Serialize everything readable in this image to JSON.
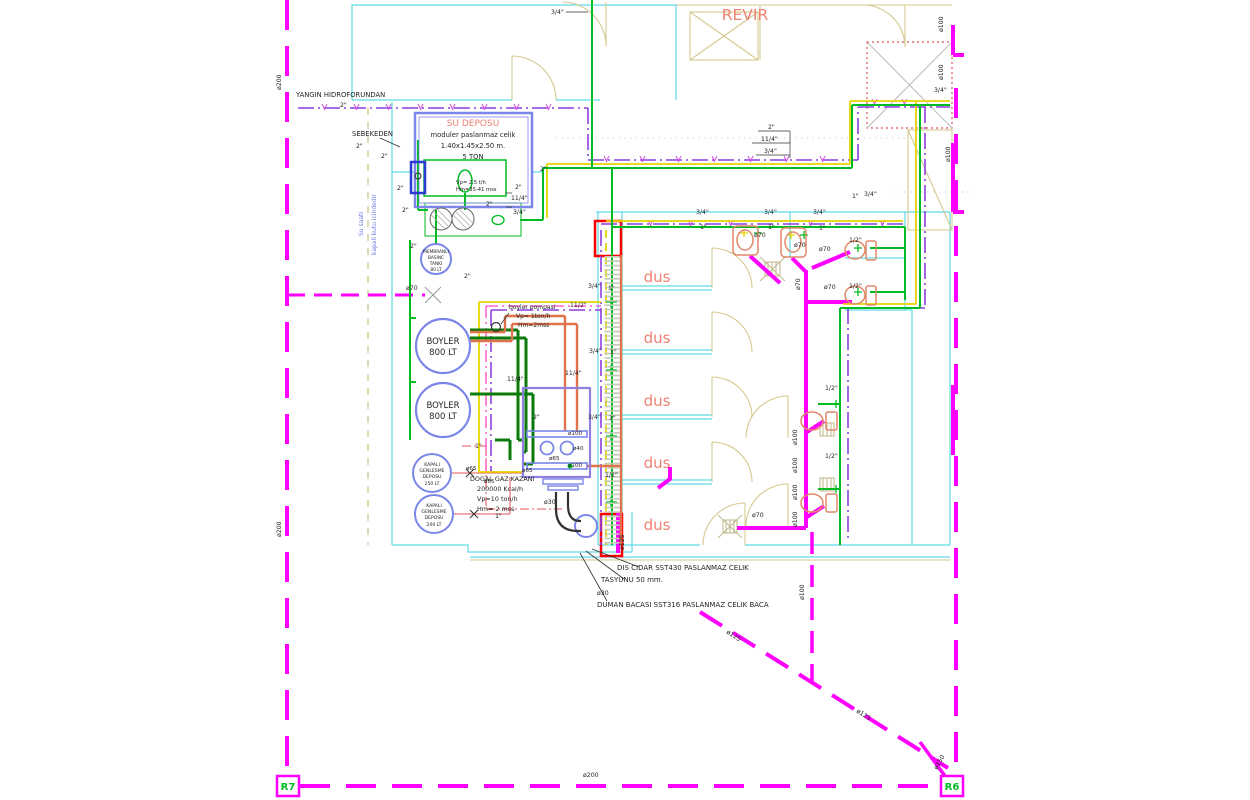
{
  "title": "Mekanik Tesisat Plani - Revir / Dus Mahalli",
  "colors": {
    "black": "#1f1f1f",
    "salmon": "#ee8172",
    "blue": "#6f7ae0",
    "green": "#00bb22",
    "magenta": "#ff00ff",
    "purple": "#8b3fe0",
    "yellow": "#e6d400",
    "orange": "#e0734b",
    "cyan_wall": "#5fd9e6",
    "tan": "#d5c98f",
    "red": "#ff0000",
    "periwinkle": "#7b86e8"
  },
  "labels": [
    {
      "id": "yangin-hidroforundan-label",
      "t": "YANGIN HIDROFORUNDAN",
      "x": 296,
      "y": 97,
      "s": 6.8
    },
    {
      "id": "size-2in-01",
      "t": "2\"",
      "x": 340,
      "y": 107
    },
    {
      "id": "sebekeden-label",
      "t": "SEBEKEDEN",
      "x": 352,
      "y": 136,
      "s": 6.8
    },
    {
      "id": "size-2in-02",
      "t": "2\"",
      "x": 356,
      "y": 148
    },
    {
      "id": "su-deposu-title",
      "t": "SU DEPOSU",
      "x": 473,
      "y": 126,
      "s": 9,
      "c": "salmon",
      "a": "m"
    },
    {
      "id": "su-deposu-spec-1",
      "t": "moduler paslanmaz celik",
      "x": 473,
      "y": 137,
      "s": 6.8,
      "a": "m"
    },
    {
      "id": "su-deposu-spec-2",
      "t": "1.40x1.45x2.50 m.",
      "x": 473,
      "y": 148,
      "s": 6.8,
      "a": "m"
    },
    {
      "id": "su-deposu-spec-3",
      "t": "5 TON",
      "x": 473,
      "y": 159,
      "s": 6.8,
      "a": "m"
    },
    {
      "id": "hidrofor-spec-1",
      "t": "Vp= 2.5 t/h",
      "x": 456,
      "y": 184,
      "s": 5.2
    },
    {
      "id": "hidrofor-spec-2",
      "t": "Hm=35-41 mss",
      "x": 456,
      "y": 191,
      "s": 5.2
    },
    {
      "id": "su-saati-note-1",
      "t": "Su saati",
      "x": 363,
      "y": 236,
      "s": 6,
      "c": "blue",
      "r": -90
    },
    {
      "id": "su-saati-note-2",
      "t": "kapali kutu icindedir",
      "x": 376,
      "y": 255,
      "s": 6,
      "c": "blue",
      "r": -90
    },
    {
      "id": "size-2in-03",
      "t": "2\"",
      "x": 381,
      "y": 158
    },
    {
      "id": "size-2in-04",
      "t": "2\"",
      "x": 397,
      "y": 190
    },
    {
      "id": "size-2in-05",
      "t": "2\"",
      "x": 402,
      "y": 212
    },
    {
      "id": "size-2in-06",
      "t": "2\"",
      "x": 410,
      "y": 248
    },
    {
      "id": "size-2in-07",
      "t": "2\"",
      "x": 486,
      "y": 206
    },
    {
      "id": "size-2in-08",
      "t": "2\"",
      "x": 515,
      "y": 189
    },
    {
      "id": "size-114-01",
      "t": "11/4\"",
      "x": 511,
      "y": 200
    },
    {
      "id": "size-34-01",
      "t": "3/4\"",
      "x": 513,
      "y": 214
    },
    {
      "id": "size-2in-09",
      "t": "2\"",
      "x": 540,
      "y": 171
    },
    {
      "id": "membran-tank-line-1",
      "t": "MEMBRANLI",
      "x": 436,
      "y": 253,
      "s": 4.3,
      "a": "m"
    },
    {
      "id": "membran-tank-line-2",
      "t": "BASINC",
      "x": 436,
      "y": 259,
      "s": 4.3,
      "a": "m"
    },
    {
      "id": "membran-tank-line-3",
      "t": "TANKI",
      "x": 436,
      "y": 265,
      "s": 4.3,
      "a": "m"
    },
    {
      "id": "membran-tank-line-4",
      "t": "80 LT",
      "x": 436,
      "y": 271,
      "s": 4.3,
      "a": "m"
    },
    {
      "id": "size-2in-10",
      "t": "2\"",
      "x": 464,
      "y": 278
    },
    {
      "id": "dia70-01",
      "t": "ø70",
      "x": 406,
      "y": 290
    },
    {
      "id": "boyler-pompasi-line-1",
      "t": "boyler pompasi",
      "x": 509,
      "y": 309,
      "s": 6
    },
    {
      "id": "boyler-pompasi-line-2",
      "t": "Vp= 1ton/h",
      "x": 516,
      "y": 318,
      "s": 6
    },
    {
      "id": "boyler-pompasi-line-3",
      "t": "Hm=2mss",
      "x": 518,
      "y": 327,
      "s": 6
    },
    {
      "id": "boyler1-label-1",
      "t": "BOYLER",
      "x": 443,
      "y": 344,
      "s": 8.5,
      "a": "m"
    },
    {
      "id": "boyler1-label-2",
      "t": "800 LT",
      "x": 443,
      "y": 355,
      "s": 8.5,
      "a": "m"
    },
    {
      "id": "boyler2-label-1",
      "t": "BOYLER",
      "x": 443,
      "y": 408,
      "s": 8.5,
      "a": "m"
    },
    {
      "id": "boyler2-label-2",
      "t": "800 LT",
      "x": 443,
      "y": 419,
      "s": 8.5,
      "a": "m"
    },
    {
      "id": "size-112-01",
      "t": "11/2\"",
      "x": 570,
      "y": 307
    },
    {
      "id": "size-114-02",
      "t": "11/4\"",
      "x": 507,
      "y": 381
    },
    {
      "id": "size-114-03",
      "t": "11/4\"",
      "x": 565,
      "y": 375
    },
    {
      "id": "size-2in-11",
      "t": "2\"",
      "x": 533,
      "y": 419
    },
    {
      "id": "genlesme1-line-1",
      "t": "KAPALI",
      "x": 432,
      "y": 466,
      "s": 4.6,
      "a": "m"
    },
    {
      "id": "genlesme1-line-2",
      "t": "GENLESME",
      "x": 432,
      "y": 472,
      "s": 4.6,
      "a": "m"
    },
    {
      "id": "genlesme1-line-3",
      "t": "DEPOSU",
      "x": 432,
      "y": 478,
      "s": 4.6,
      "a": "m"
    },
    {
      "id": "genlesme1-line-4",
      "t": "250 LT",
      "x": 432,
      "y": 485,
      "s": 4.6,
      "a": "m"
    },
    {
      "id": "genlesme2-line-1",
      "t": "KAPALI",
      "x": 434,
      "y": 507,
      "s": 4.6,
      "a": "m"
    },
    {
      "id": "genlesme2-line-2",
      "t": "GENLESME",
      "x": 434,
      "y": 513,
      "s": 4.6,
      "a": "m"
    },
    {
      "id": "genlesme2-line-3",
      "t": "DEPOSU",
      "x": 434,
      "y": 519,
      "s": 4.6,
      "a": "m"
    },
    {
      "id": "genlesme2-line-4",
      "t": "200 LT",
      "x": 434,
      "y": 526,
      "s": 4.6,
      "a": "m"
    },
    {
      "id": "size-1in-01",
      "t": "1\"",
      "x": 475,
      "y": 448
    },
    {
      "id": "size-1in-02",
      "t": "1\"",
      "x": 495,
      "y": 518
    },
    {
      "id": "dogalgaz-kazani-line-1",
      "t": "DOGAL GAZ KAZANI",
      "x": 470,
      "y": 481,
      "s": 6.4
    },
    {
      "id": "dogalgaz-kazani-line-2",
      "t": "200000 Kcal/h",
      "x": 477,
      "y": 491,
      "s": 6.4
    },
    {
      "id": "dogalgaz-kazani-line-3",
      "t": "Vp=10 ton/h",
      "x": 477,
      "y": 501,
      "s": 6.4
    },
    {
      "id": "dogalgaz-kazani-line-4",
      "t": "Hm= 2 mss",
      "x": 477,
      "y": 511,
      "s": 6.4
    },
    {
      "id": "dia100-kazan-1",
      "t": "ø100",
      "x": 568,
      "y": 435,
      "s": 5.6
    },
    {
      "id": "dia40-kazan",
      "t": "ø40",
      "x": 573,
      "y": 450,
      "s": 5.6
    },
    {
      "id": "dia65-kazan-1",
      "t": "ø65",
      "x": 549,
      "y": 460,
      "s": 5.6
    },
    {
      "id": "dia100-kazan-2",
      "t": "ø100",
      "x": 568,
      "y": 467,
      "s": 5.6
    },
    {
      "id": "dia65-kazan-2",
      "t": "ø65",
      "x": 522,
      "y": 472,
      "s": 5.6
    },
    {
      "id": "dia65-kazan-3",
      "t": "ø65",
      "x": 466,
      "y": 470,
      "s": 5.6
    },
    {
      "id": "dia65-kazan-4",
      "t": "ø65",
      "x": 484,
      "y": 483,
      "s": 5.6
    },
    {
      "id": "dia30-01",
      "t": "ø30",
      "x": 544,
      "y": 504
    },
    {
      "id": "dia125-rot-01",
      "t": "ø125",
      "x": 624,
      "y": 550,
      "r": -90
    },
    {
      "id": "chimney-note-1",
      "t": "DIS CIDAR SST430 PASLANMAZ CELIK",
      "x": 617,
      "y": 570,
      "s": 7
    },
    {
      "id": "chimney-note-2",
      "t": "TASYUNU 50 mm.",
      "x": 601,
      "y": 582,
      "s": 7
    },
    {
      "id": "dia30-02",
      "t": "ø30",
      "x": 597,
      "y": 595
    },
    {
      "id": "chimney-note-3",
      "t": "DUMAN BACASI SST316 PASLANMAZ CELIK BACA",
      "x": 597,
      "y": 607,
      "s": 7
    },
    {
      "id": "dus-label-1",
      "t": "dus",
      "x": 657,
      "y": 282,
      "s": 15,
      "c": "salmon",
      "a": "m"
    },
    {
      "id": "dus-label-2",
      "t": "dus",
      "x": 657,
      "y": 343,
      "s": 15,
      "c": "salmon",
      "a": "m"
    },
    {
      "id": "dus-label-3",
      "t": "dus",
      "x": 657,
      "y": 406,
      "s": 15,
      "c": "salmon",
      "a": "m"
    },
    {
      "id": "dus-label-4",
      "t": "dus",
      "x": 657,
      "y": 468,
      "s": 15,
      "c": "salmon",
      "a": "m"
    },
    {
      "id": "dus-label-5",
      "t": "dus",
      "x": 657,
      "y": 530,
      "s": 15,
      "c": "salmon",
      "a": "m"
    },
    {
      "id": "revir-label",
      "t": "REVIR",
      "x": 745,
      "y": 20,
      "s": 15.5,
      "c": "salmon",
      "a": "m"
    },
    {
      "id": "size-34-02",
      "t": "3/4\"",
      "x": 588,
      "y": 288
    },
    {
      "id": "size-1in-03",
      "t": "1\"",
      "x": 608,
      "y": 290
    },
    {
      "id": "size-34-03",
      "t": "3/4\"",
      "x": 589,
      "y": 353
    },
    {
      "id": "size-1in-04",
      "t": "1\"",
      "x": 610,
      "y": 354
    },
    {
      "id": "size-34-04",
      "t": "3/4\"",
      "x": 588,
      "y": 419
    },
    {
      "id": "size-1in-05",
      "t": "1\"",
      "x": 609,
      "y": 420
    },
    {
      "id": "size-12-01",
      "t": "1/2\"",
      "x": 605,
      "y": 477
    },
    {
      "id": "size-34-05",
      "t": "3/4\"",
      "x": 696,
      "y": 214
    },
    {
      "id": "size-1in-06",
      "t": "1\"",
      "x": 700,
      "y": 229
    },
    {
      "id": "size-34-06",
      "t": "3/4\"",
      "x": 764,
      "y": 214
    },
    {
      "id": "size-1in-07",
      "t": "1\"",
      "x": 768,
      "y": 229
    },
    {
      "id": "size-34-07",
      "t": "3/4\"",
      "x": 813,
      "y": 214
    },
    {
      "id": "size-1in-08",
      "t": "1\"",
      "x": 819,
      "y": 230
    },
    {
      "id": "dia70-02",
      "t": "ø70",
      "x": 754,
      "y": 237
    },
    {
      "id": "dia70-03",
      "t": "ø70",
      "x": 794,
      "y": 247
    },
    {
      "id": "dia70-04",
      "t": "ø70",
      "x": 819,
      "y": 251
    },
    {
      "id": "dia70-rot-01",
      "t": "ø70",
      "x": 800,
      "y": 290,
      "r": -90
    },
    {
      "id": "dia70-05",
      "t": "ø70",
      "x": 824,
      "y": 289
    },
    {
      "id": "size-12-02",
      "t": "1/2\"",
      "x": 849,
      "y": 242
    },
    {
      "id": "size-12-03",
      "t": "1/2\"",
      "x": 849,
      "y": 288
    },
    {
      "id": "size-12-04",
      "t": "1/2\"",
      "x": 825,
      "y": 390
    },
    {
      "id": "size-12-05",
      "t": "1/2\"",
      "x": 825,
      "y": 458
    },
    {
      "id": "size-1in-09",
      "t": "1\"",
      "x": 852,
      "y": 198
    },
    {
      "id": "size-34-08",
      "t": "3/4\"",
      "x": 864,
      "y": 196
    },
    {
      "id": "size-34-09",
      "t": "3/4\"",
      "x": 934,
      "y": 92
    },
    {
      "id": "size-2in-12",
      "t": "2\"",
      "x": 768,
      "y": 129
    },
    {
      "id": "size-114-04",
      "t": "11/4\"",
      "x": 761,
      "y": 141
    },
    {
      "id": "size-34-10",
      "t": "3/4\"",
      "x": 764,
      "y": 153
    },
    {
      "id": "size-34-11",
      "t": "3/4\"",
      "x": 551,
      "y": 14
    },
    {
      "id": "dia100-rot-01",
      "t": "ø100",
      "x": 797,
      "y": 445,
      "r": -90
    },
    {
      "id": "dia100-rot-02",
      "t": "ø100",
      "x": 797,
      "y": 473,
      "r": -90
    },
    {
      "id": "dia100-rot-03",
      "t": "ø100",
      "x": 797,
      "y": 500,
      "r": -90
    },
    {
      "id": "dia100-rot-04",
      "t": "ø100",
      "x": 797,
      "y": 527,
      "r": -90
    },
    {
      "id": "dia100-rot-05",
      "t": "ø100",
      "x": 804,
      "y": 600,
      "r": -90
    },
    {
      "id": "dia100-rot-06",
      "t": "ø100",
      "x": 943,
      "y": 32,
      "r": -90
    },
    {
      "id": "dia100-rot-07",
      "t": "ø100",
      "x": 943,
      "y": 80,
      "r": -90
    },
    {
      "id": "dia100-rot-08",
      "t": "ø100",
      "x": 950,
      "y": 162,
      "r": -90
    },
    {
      "id": "dia70-06",
      "t": "ø70",
      "x": 752,
      "y": 517
    },
    {
      "id": "dia125-diag-1",
      "t": "ø125",
      "x": 726,
      "y": 633,
      "r": 33
    },
    {
      "id": "dia125-diag-2",
      "t": "ø125",
      "x": 856,
      "y": 712,
      "r": 33
    },
    {
      "id": "dia150-rot",
      "t": "ø150",
      "x": 937,
      "y": 770,
      "r": -60
    },
    {
      "id": "dia200-rot-1",
      "t": "ø200",
      "x": 281,
      "y": 90,
      "r": -90
    },
    {
      "id": "dia200-rot-2",
      "t": "ø200",
      "x": 281,
      "y": 537,
      "r": -90
    },
    {
      "id": "dia200-bottom",
      "t": "ø200",
      "x": 583,
      "y": 777
    },
    {
      "id": "r7-marker-label",
      "t": "R7",
      "x": 288,
      "y": 790,
      "s": 10,
      "c": "green",
      "a": "m",
      "w": "b"
    },
    {
      "id": "r6-marker-label",
      "t": "R6",
      "x": 952,
      "y": 790,
      "s": 10,
      "c": "green",
      "a": "m",
      "w": "b"
    }
  ]
}
